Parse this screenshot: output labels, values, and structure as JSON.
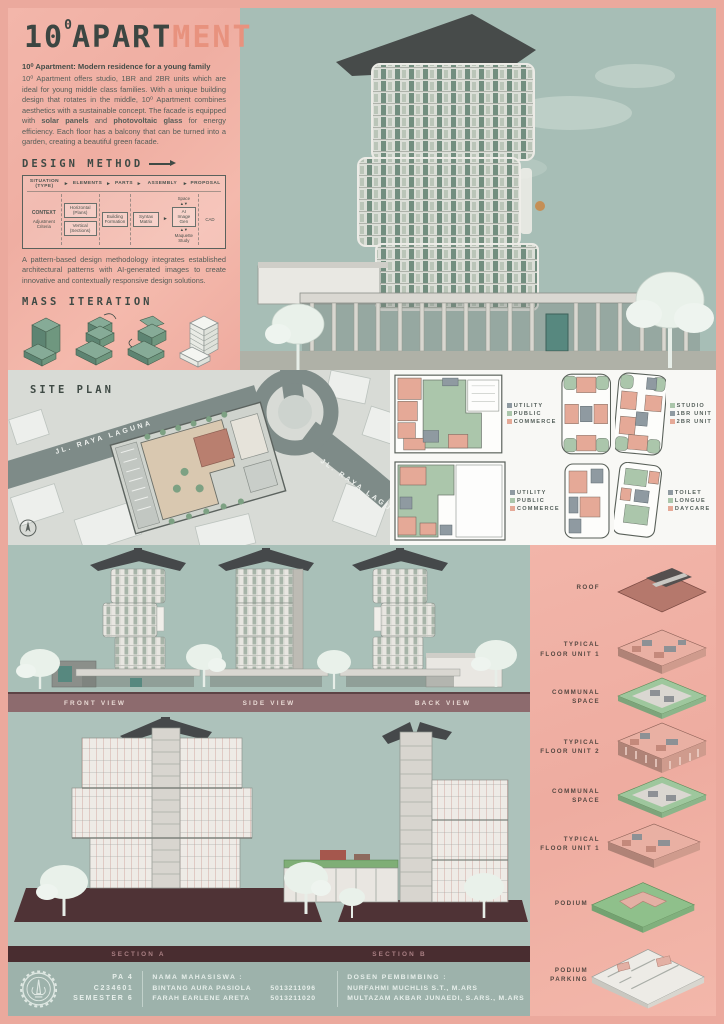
{
  "poster": {
    "title": {
      "num": "10",
      "deg": "0",
      "dark": "APART",
      "accent": "MENT"
    },
    "colors": {
      "accent_salmon": "#e8927e",
      "panel_pink": "#f2b4a8",
      "sage": "#a9c0b8",
      "ink": "#3f4a45",
      "maroon_bar": "#492d30",
      "mauve_bar": "#8d6b6e",
      "footer_bg": "#9db2ab"
    }
  },
  "intro": {
    "heading": "10⁰ Apartment: Modern residence for a young family",
    "seg1": "10⁰ Apartment offers studio, 1BR and 2BR units which are ideal for young middle class families. With a unique building design that rotates in the middle, 10⁰ Apartment combines aesthetics with a sustainable concept. The facade is equipped with ",
    "bold1": "solar panels",
    "seg2": " and ",
    "bold2": "photovoltaic glass",
    "seg3": " for energy efficiency. Each floor has a balcony that can be turned into a garden, creating a beautiful green facade."
  },
  "design_method": {
    "heading": "DESIGN METHOD",
    "flow": {
      "headers": [
        "SITUATION (TYPE)",
        "ELEMENTS",
        "PARTS",
        "ASSEMBLY",
        "PROPOSAL"
      ],
      "situation": [
        "CONTEXT",
        "Adjustment Criteria"
      ],
      "elements": [
        "Horizontal (Plans)",
        "Vertical (Sections)"
      ],
      "parts": "Building Formation",
      "assembly": {
        "pre": "Syntax Matrix",
        "top": "Space",
        "mid": "AI Image Gen",
        "bottom": "Maquette Study"
      },
      "proposal": "CAD"
    },
    "description": "A pattern-based design methodology integrates established architectural patterns with AI-generated images to create innovative and contextually responsive design solutions."
  },
  "mass_iteration": {
    "heading": "MASS ITERATION"
  },
  "site_plan": {
    "heading": "SITE PLAN",
    "road_labels": [
      "JL. RAYA LAGUNA",
      "JL. RAYA LAGUNA"
    ]
  },
  "floor_plans": {
    "legend_zoning": {
      "items": [
        {
          "label": "UTILITY",
          "color": "#8f9aa1"
        },
        {
          "label": "PUBLIC",
          "color": "#abc6ab"
        },
        {
          "label": "COMMERCE",
          "color": "#e5a997"
        }
      ]
    },
    "legend_units": {
      "items": [
        {
          "label": "STUDIO",
          "color": "#abc6ab"
        },
        {
          "label": "1BR UNIT",
          "color": "#8f9aa1"
        },
        {
          "label": "2BR UNIT",
          "color": "#e5a997"
        }
      ]
    },
    "legend_amenity": {
      "items": [
        {
          "label": "TOILET",
          "color": "#8f9aa1"
        },
        {
          "label": "LONGUE",
          "color": "#abc6ab"
        },
        {
          "label": "DAYCARE",
          "color": "#e5a997"
        }
      ]
    }
  },
  "elevations": {
    "labels": [
      "FRONT VIEW",
      "SIDE VIEW",
      "BACK VIEW"
    ]
  },
  "sections": {
    "labels": [
      "SECTION A",
      "SECTION B"
    ]
  },
  "axon": {
    "labels": [
      "ROOF",
      "TYPICAL FLOOR UNIT 1",
      "COMMUNAL SPACE",
      "TYPICAL FLOOR UNIT 2",
      "COMMUNAL SPACE",
      "TYPICAL FLOOR UNIT 1",
      "PODIUM",
      "PODIUM PARKING"
    ]
  },
  "footer": {
    "course": "PA 4",
    "code": "C234601",
    "semester": "SEMESTER 6",
    "students_heading": "NAMA MAHASISWA :",
    "students": [
      {
        "name": "BINTANG AURA PASIOLA",
        "id": "5013211096"
      },
      {
        "name": "FARAH EARLENE ARETA",
        "id": "5013211020"
      }
    ],
    "advisors_heading": "DOSEN PEMBIMBING :",
    "advisors": [
      "NURFAHMI MUCHLIS S.T., M.ARS",
      "MULTAZAM AKBAR JUNAEDI, S.ARS., M.ARS"
    ]
  }
}
